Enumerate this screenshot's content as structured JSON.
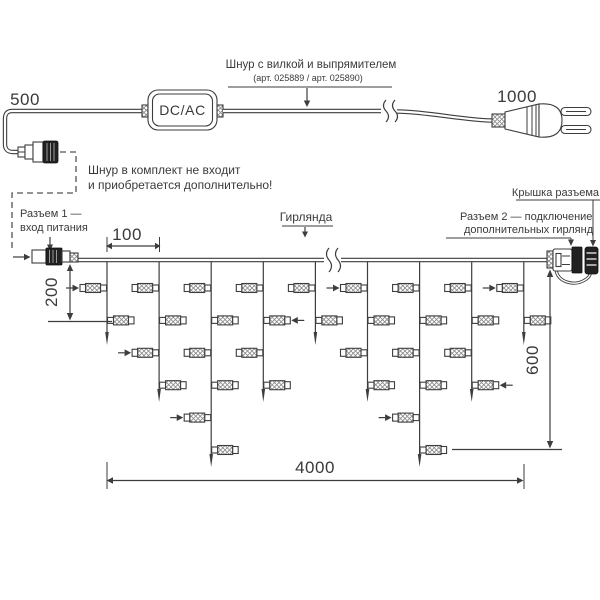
{
  "colors": {
    "line": "#3d3d3d",
    "dark_part": "#222222",
    "text": "#3a3a3a",
    "background": "#ffffff"
  },
  "power_cord": {
    "label_title": "Шнур с вилкой и выпрямителем",
    "label_art": "(арт. 025889 / арт. 025890)",
    "note_line1": "Шнур в комплект не входит",
    "note_line2": "и приобретается дополнительно!",
    "converter_label": "DC/AC",
    "length_left": "500",
    "length_right": "1000"
  },
  "garland": {
    "label": "Гирлянда",
    "connector1_label_line1": "Разъем 1 —",
    "connector1_label_line2": "вход питания",
    "connector2_label_line1": "Разъем 2 — подключение",
    "connector2_label_line2": "дополнительных гирлянд",
    "cap_label": "Крышка разъема",
    "dimensions": {
      "drop_spacing": "100",
      "first_drop": "200",
      "max_drop": "600",
      "total_length": "4000"
    },
    "drops": [
      {
        "lamps": 2,
        "arrow_lamp": 0
      },
      {
        "lamps": 4,
        "arrow_lamp": 2
      },
      {
        "lamps": 6,
        "arrow_lamp": 4
      },
      {
        "lamps": 4,
        "arrow_lamp": 1
      },
      {
        "lamps": 2,
        "arrow_lamp": null
      },
      {
        "lamps": 4,
        "arrow_lamp": 0
      },
      {
        "lamps": 6,
        "arrow_lamp": 4
      },
      {
        "lamps": 4,
        "arrow_lamp": 3
      },
      {
        "lamps": 2,
        "arrow_lamp": 0
      }
    ]
  }
}
